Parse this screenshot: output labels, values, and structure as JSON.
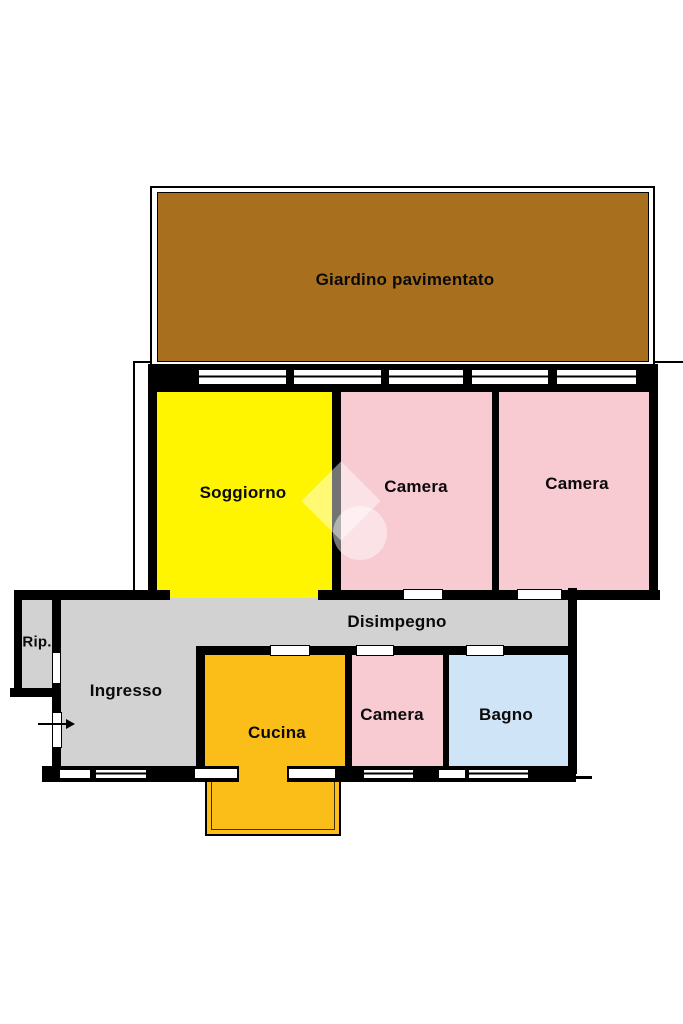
{
  "plan": {
    "title": "Planimetria appartamento",
    "rooms": {
      "giardino": {
        "label": "Giardino pavimentato"
      },
      "soggiorno": {
        "label": "Soggiorno"
      },
      "camera1": {
        "label": "Camera"
      },
      "camera2": {
        "label": "Camera"
      },
      "disimpegno": {
        "label": "Disimpegno"
      },
      "rip": {
        "label": "Rip."
      },
      "ingresso": {
        "label": "Ingresso"
      },
      "cucina": {
        "label": "Cucina"
      },
      "camera3": {
        "label": "Camera"
      },
      "bagno": {
        "label": "Bagno"
      }
    },
    "colors": {
      "garden": "#A8701E",
      "living": "#FFF500",
      "bedroom": "#F8CBD3",
      "kitchen": "#FBBE18",
      "bath": "#CFE4F6",
      "hall": "#D2D2D2",
      "wall": "#000000",
      "text": "#0a0a0a",
      "watermark": "rgba(255,255,255,0.45)"
    }
  }
}
